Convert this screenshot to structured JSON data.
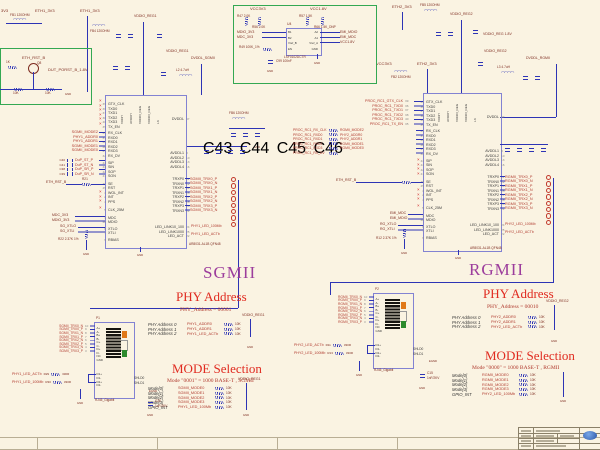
{
  "colors": {
    "wire": "#2d34b5",
    "net_red": "#b03a2e",
    "maroon": "#7e2c20",
    "green_box": "#33a852",
    "ic_border": "#8282d2",
    "title_red": "#e02b20",
    "bus_purple": "#9c3d9c",
    "bg": "#faf3e2"
  },
  "titles": {
    "sgmii": "SGMII",
    "rgmii": "RGMII",
    "phy_addr": "PHY Address",
    "mode_sel": "MODE Selection",
    "phy_addr_left_val": "PHY_Address = 00001",
    "mode_left_val": "Mode \"0001\" = 1000 BASE-T , SGMII",
    "phy_addr_right_val": "PHY_Address = 00010",
    "mode_right_val": "Mode \"0000\" = 1000 BASE-T , RGMII"
  },
  "labels": {
    "gnd": "GND",
    "p3v3": "3V3",
    "fb1": "FB1 120OHM",
    "eth1": "ETH1_3V3",
    "fb4": "FB4 120OHM",
    "vddio1": "VDDIO_REG1",
    "l2": "L2 4.7uH",
    "dvddl_sg": "DVDDL_SGMII",
    "vcc3v3": "VCC3V3",
    "fb2": "FB2 120OHM",
    "eth2": "ETH2_3V3",
    "fb5": "FB5 120OHM",
    "vddio2": "VDDIO_REG2",
    "vddio18": "VDDIO_REG 1.8V",
    "l3": "L3 4.7uH",
    "dvddl_rg": "DVDDL_RGMII",
    "fb6": "FB6 120OHM",
    "part": "AR8031-AL1B QFN48"
  },
  "ic": {
    "pins_top": [
      "VDDH",
      "AVDDH",
      "VDDIO_REG",
      "VDDIO_REG",
      "LX"
    ],
    "grp_tx": [
      {
        "n": "39",
        "t": "GTX_CLK"
      },
      {
        "n": "36",
        "t": "TXD0"
      },
      {
        "n": "37",
        "t": "TXD1"
      },
      {
        "n": "38",
        "t": "TXD2"
      },
      {
        "n": "40",
        "t": "TXD3"
      },
      {
        "n": "35",
        "t": "TX_EN"
      }
    ],
    "grp_rx": [
      {
        "n": "33",
        "t": "RX_CLK"
      },
      {
        "n": "31",
        "t": "RXD0"
      },
      {
        "n": "30",
        "t": "RXD1"
      },
      {
        "n": "28",
        "t": "RXD2"
      },
      {
        "n": "27",
        "t": "RXD3"
      },
      {
        "n": "32",
        "t": "RX_DV"
      }
    ],
    "grp_ser": [
      {
        "n": "44",
        "t": "SIP"
      },
      {
        "n": "43",
        "t": "SIN"
      },
      {
        "n": "42",
        "t": "SOP"
      },
      {
        "n": "41",
        "t": "SON"
      }
    ],
    "grp_ctl": [
      {
        "n": "46",
        "t": "SE"
      },
      {
        "n": "45",
        "t": "RST"
      },
      {
        "n": "3",
        "t": "WOL_INT"
      },
      {
        "n": "2",
        "t": "INT"
      },
      {
        "n": "4",
        "t": "PPS"
      }
    ],
    "grp_clk": [
      {
        "n": "5",
        "t": "CLK_25M"
      }
    ],
    "grp_mdio": [
      {
        "n": "1",
        "t": "MDC"
      },
      {
        "n": "48",
        "t": "MDIO"
      }
    ],
    "grp_xtl": [
      {
        "n": "6",
        "t": "XTLO"
      },
      {
        "n": "7",
        "t": "XTLI"
      }
    ],
    "grp_rbias": [
      {
        "n": "9",
        "t": "RBIAS"
      }
    ],
    "right_pwr": [
      {
        "n": "47",
        "t": "DVDDL"
      }
    ],
    "right_avdd": [
      {
        "n": "8",
        "t": "AVDDL1"
      },
      {
        "n": "10",
        "t": "AVDDL2"
      },
      {
        "n": "13",
        "t": "AVDDL3"
      },
      {
        "n": "16",
        "t": "AVDDL4"
      }
    ],
    "right_trx": [
      {
        "n": "11",
        "t": "TRXP0"
      },
      {
        "n": "12",
        "t": "TRXN0"
      },
      {
        "n": "14",
        "t": "TRXP1"
      },
      {
        "n": "15",
        "t": "TRXN1"
      },
      {
        "n": "17",
        "t": "TRXP2"
      },
      {
        "n": "18",
        "t": "TRXN2"
      },
      {
        "n": "20",
        "t": "TRXP3"
      },
      {
        "n": "21",
        "t": "TRXN3"
      }
    ],
    "right_led": [
      {
        "n": "24",
        "t": "LED_LINK10_100"
      },
      {
        "n": "25",
        "t": "LED_LINK1000"
      },
      {
        "n": "22",
        "t": "LED_ACT"
      }
    ]
  },
  "sgmii": {
    "straps": [
      "SGMII_MODE2",
      "PHY1_ADDR0",
      "PHY1_ADDR1",
      "SGMII_MODE1",
      "SGMII_MODE0"
    ],
    "dup": [
      {
        "c": "C40",
        "t": "DuP_ST_P"
      },
      {
        "c": "C41",
        "t": "DuP_ST_N"
      },
      {
        "c": "C38",
        "t": "DuP_SR_P"
      },
      {
        "c": "C39",
        "t": "DuP_SR_N"
      }
    ],
    "rst": "ETH_RST_B",
    "rst_r": "R21",
    "mdc": "MDC_3V3",
    "mdio": "MDIO_3V3",
    "xtlo": "SG_XTLO",
    "xtli": "SG_XTLI",
    "rbias": "R22 2.37K 1%",
    "trx": [
      "SGMII_TRX0_P",
      "SGMII_TRX0_N",
      "SGMII_TRX1_P",
      "SGMII_TRX1_N",
      "SGMII_TRX2_P",
      "SGMII_TRX2_N",
      "SGMII_TRX3_P",
      "SGMII_TRX3_N"
    ],
    "led": [
      "PHY1_LED_100Mb",
      "PHY1_LED_ACTb"
    ],
    "avdd_caps": [
      "C43",
      "C44",
      "C45",
      "C46"
    ]
  },
  "rgmii": {
    "tx": [
      {
        "t": "PROC_RC1_GTX_CLK",
        "n": "39"
      },
      {
        "t": "PROC_RC1_TXD0",
        "n": "36"
      },
      {
        "t": "PROC_RC1_TXD1",
        "n": "37"
      },
      {
        "t": "PROC_RC1_TXD2",
        "n": "38"
      },
      {
        "t": "PROC_RC1_TXD3",
        "n": "40"
      },
      {
        "t": "PROC_RC1_TX_EN",
        "n": "35"
      }
    ],
    "rx": [
      {
        "a": "PROC_RC1_RX_CLK",
        "b": "RGMII_MODE2"
      },
      {
        "a": "PROC_RC1_RXD0",
        "b": "PHY2_ADDR0"
      },
      {
        "a": "PROC_RC1_RXD1",
        "b": "PHY2_ADDR1"
      },
      {
        "a": "PROC_RC1_RXD2",
        "b": "RGMII_MODE1"
      },
      {
        "a": "PROC_RC1_RXD3",
        "b": "RGMII_MODE0"
      },
      {
        "a": "PROC_RC1_RX_DV",
        "b": ""
      }
    ],
    "rst": "ETH_RST_B",
    "mdc": "EMI_MDC",
    "mdio": "EMI_MDIO",
    "xtlo": "RG_XTLO",
    "xtli": "RG_XTLI",
    "rbias": "R12 2.37K 1%",
    "trx": [
      "RGMII_TRX0_P",
      "RGMII_TRX0_N",
      "RGMII_TRX1_P",
      "RGMII_TRX1_N",
      "RGMII_TRX2_P",
      "RGMII_TRX2_N",
      "RGMII_TRX3_P",
      "RGMII_TRX3_N"
    ],
    "led": [
      "PHY2_LED_100Mb",
      "PHY2_LED_ACTb"
    ]
  },
  "addr_left": {
    "pwr": "VDDIO_REG1",
    "rows": [
      {
        "lbl": "PHY Address 0",
        "net": "PHY1_ADDR0",
        "r": "10K"
      },
      {
        "lbl": "PHY Address 1",
        "net": "PHY1_ADDR1",
        "r": "10K"
      },
      {
        "lbl": "PHY Address 2",
        "net": "PHY1_LED_ACTb",
        "r": "10K"
      }
    ]
  },
  "mode_left": {
    "pwr": "VDDIO_REG1",
    "rows": [
      {
        "lbl": "Mode[0]",
        "net": "SGMII_MODE0",
        "r": "10K"
      },
      {
        "lbl": "Mode[1]",
        "net": "SGMII_MODE1",
        "r": "10K"
      },
      {
        "lbl": "Mode[2]",
        "net": "SGMII_MODE2",
        "r": "10K"
      },
      {
        "lbl": "Mode[3]",
        "net": "SGMII_MODE3",
        "r": "10K"
      },
      {
        "lbl": "GPIO_INT",
        "net": "PHY1_LED_100Mb",
        "r": "10K"
      }
    ]
  },
  "addr_right": {
    "pwr": "VDDIO_REG2",
    "rows": [
      {
        "lbl": "PHY Address 0",
        "net": "PHY2_ADDR0",
        "r": "10K"
      },
      {
        "lbl": "PHY Address 1",
        "net": "PHY2_ADDR1",
        "r": "10K"
      },
      {
        "lbl": "PHY Address 2",
        "net": "PHY2_LED_ACTb",
        "r": "10K"
      }
    ]
  },
  "mode_right": {
    "pwr": "VDDIO_REG2",
    "rows": [
      {
        "lbl": "Mode[0]",
        "net": "RGMII_MODE0",
        "r": "10K"
      },
      {
        "lbl": "Mode[1]",
        "net": "RGMII_MODE1",
        "r": "10K"
      },
      {
        "lbl": "Mode[2]",
        "net": "RGMII_MODE2",
        "r": "10K"
      },
      {
        "lbl": "Mode[3]",
        "net": "RGMII_MODE3",
        "r": "10K"
      },
      {
        "lbl": "GPIO_INT",
        "net": "PHY2_LED_100Mb",
        "r": "10K"
      }
    ]
  },
  "rj45": {
    "label": "RJ45_Gigabit",
    "pins": [
      "A+",
      "A-",
      "B+",
      "B-",
      "C+",
      "C-",
      "D+",
      "D-",
      "NC",
      "GND"
    ],
    "led_pins": [
      "D1+",
      "D1-",
      "D2+",
      "D2-"
    ],
    "shld": [
      "SHLD0",
      "SHLD1"
    ],
    "egnd": "EGND",
    "cap_val": "1nF/2KV"
  },
  "rj45_left": {
    "ref": "P1",
    "cap_ref": "C30",
    "inputs": [
      {
        "t": "SGMII_TRX0_N",
        "n": "10"
      },
      {
        "t": "SGMII_TRX0_P",
        "n": "9"
      },
      {
        "t": "SGMII_TRX1_N",
        "n": "8"
      },
      {
        "t": "SGMII_TRX1_P",
        "n": "7"
      },
      {
        "t": "SGMII_TRX2_N",
        "n": "6"
      },
      {
        "t": "SGMII_TRX2_P",
        "n": "5"
      },
      {
        "t": "SGMII_TRX3_N",
        "n": "4"
      },
      {
        "t": "SGMII_TRX3_P",
        "n": "3"
      }
    ],
    "led": [
      {
        "t": "PHY1_LED_ACTb",
        "r": "R29",
        "v": "330R"
      },
      {
        "t": "PHY1_LED_100Mb",
        "r": "R30",
        "v": "330R"
      }
    ]
  },
  "rj45_right": {
    "ref": "P2",
    "cap_ref": "C15",
    "inputs": [
      {
        "t": "RGMII_TRX0_N",
        "n": "10"
      },
      {
        "t": "RGMII_TRX0_P",
        "n": "9"
      },
      {
        "t": "RGMII_TRX1_N",
        "n": "8"
      },
      {
        "t": "RGMII_TRX1_P",
        "n": "7"
      },
      {
        "t": "RGMII_TRX2_N",
        "n": "6"
      },
      {
        "t": "RGMII_TRX2_P",
        "n": "5"
      },
      {
        "t": "RGMII_TRX3_N",
        "n": "4"
      },
      {
        "t": "RGMII_TRX3_P",
        "n": "3"
      }
    ],
    "led": [
      {
        "t": "PHY2_LED_ACTb",
        "r": "R11",
        "v": "330R"
      },
      {
        "t": "PHY2_LED_100Mb",
        "r": "R13",
        "v": "330R"
      }
    ]
  },
  "reset": {
    "net": "ETH_RST_B",
    "out": "DUT_PORST_B_1.8V",
    "q": "Q8",
    "r1": "1K",
    "r2": "10K",
    "r3": "10K"
  },
  "shifter": {
    "ref": "U4",
    "part": "LSF0102DCTR",
    "vl": "VCC3V3",
    "vr": "VCC1.8V",
    "rl": [
      "R47 2.0K",
      "R56 2.0K"
    ],
    "rr": [
      "R57 1.5K",
      "R66 1.5K_DNP"
    ],
    "pins_l": [
      "B1",
      "B2",
      "Vref_B",
      "EN"
    ],
    "pins_r": [
      "A2",
      "A1",
      "Vref_A",
      "GND"
    ],
    "nets_l": [
      "MDIO_3V3",
      "MDC_3V3"
    ],
    "nets_r": [
      "EMI_MDIO",
      "EMI_MDC",
      "VCC1.8V"
    ],
    "r49": "R49 100K_1%",
    "c99": "C99 100nF"
  }
}
